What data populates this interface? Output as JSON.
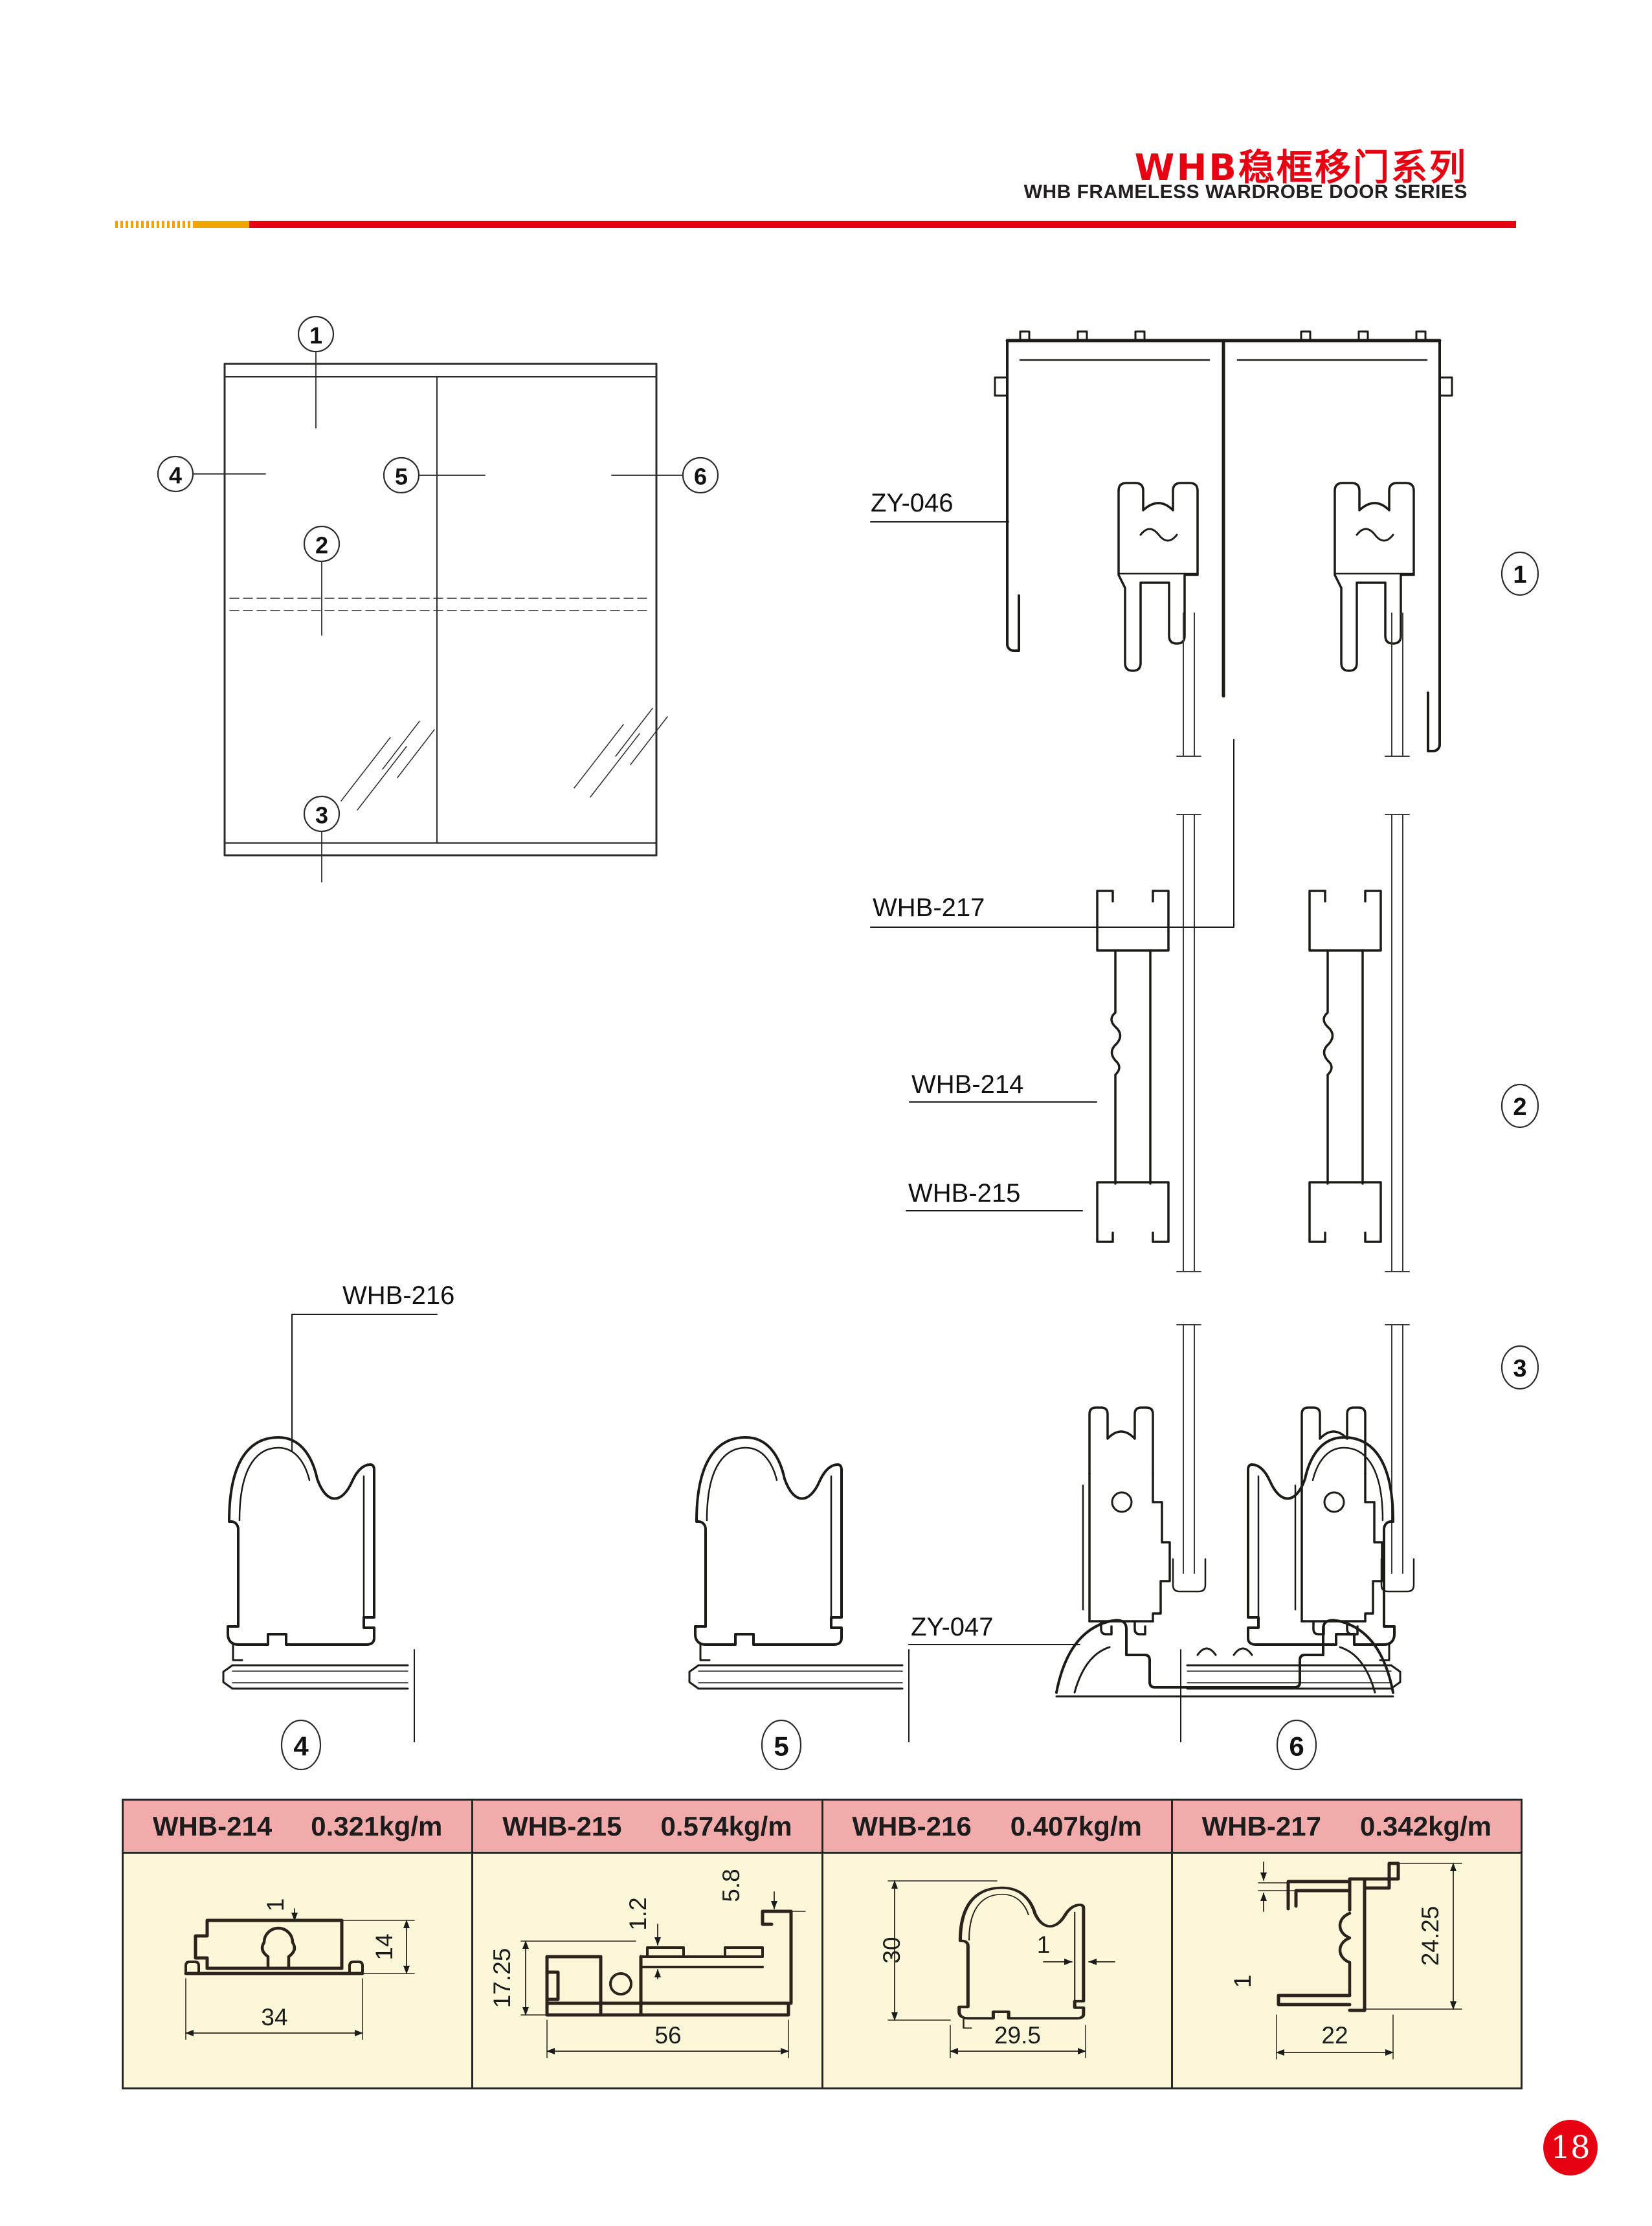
{
  "header": {
    "title_zh": "WHB稳框移门系列",
    "title_en": "WHB FRAMELESS WARDROBE DOOR SERIES",
    "accent_red": "#e60012",
    "accent_orange": "#f0a500"
  },
  "elevation": {
    "callouts": [
      "1",
      "2",
      "3",
      "4",
      "5",
      "6"
    ]
  },
  "sections": {
    "labels": {
      "zy046": "ZY-046",
      "whb217": "WHB-217",
      "whb214": "WHB-214",
      "whb215": "WHB-215",
      "zy047": "ZY-047",
      "whb216": "WHB-216"
    },
    "callouts_right": [
      "1",
      "2",
      "3"
    ],
    "callouts_bottom": [
      "4",
      "5",
      "6"
    ]
  },
  "table": {
    "header_bg": "#f2abab",
    "body_bg": "#fbf8da",
    "columns": [
      {
        "model": "WHB-214",
        "weight": "0.321kg/m",
        "dims": [
          "1",
          "14",
          "34"
        ]
      },
      {
        "model": "WHB-215",
        "weight": "0.574kg/m",
        "dims": [
          "17.25",
          "1.2",
          "5.8",
          "56"
        ]
      },
      {
        "model": "WHB-216",
        "weight": "0.407kg/m",
        "dims": [
          "30",
          "1",
          "29.5"
        ]
      },
      {
        "model": "WHB-217",
        "weight": "0.342kg/m",
        "dims": [
          "1",
          "24.25",
          "22"
        ]
      }
    ]
  },
  "page_number": "18"
}
